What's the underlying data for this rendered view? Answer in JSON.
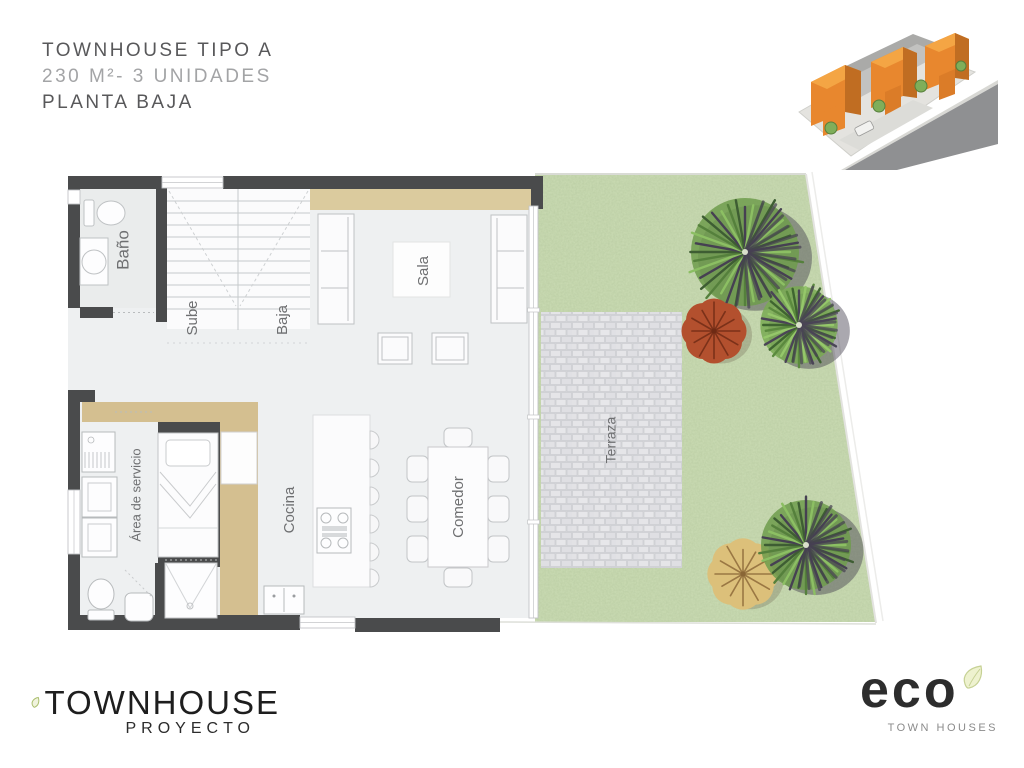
{
  "header": {
    "line1": "TOWNHOUSE TIPO A",
    "line2": "230 M²- 3 UNIDADES",
    "line3": "PLANTA BAJA"
  },
  "plan": {
    "labels": {
      "bano": "Baño",
      "sube": "Sube",
      "baja": "Baja",
      "sala": "Sala",
      "cocina": "Cocina",
      "comedor": "Comedor",
      "servicio": "Área de servicio",
      "terraza": "Terraza"
    },
    "trees": [
      {
        "type": "palm",
        "cx": 745,
        "cy": 252,
        "r": 60,
        "base": "#6f9c4c",
        "fronds": [
          "#8cbf63",
          "#55803c",
          "#3e5d33",
          "#464052"
        ],
        "shadow": true
      },
      {
        "type": "palm",
        "cx": 799,
        "cy": 325,
        "r": 43,
        "base": "#79aa52",
        "fronds": [
          "#95c76a",
          "#5b8a3e",
          "#3f6530",
          "#4a4456"
        ],
        "shadow": true
      },
      {
        "type": "round",
        "cx": 714,
        "cy": 331,
        "r": 31,
        "base": "#b3502e",
        "branch": "#6e2a14"
      },
      {
        "type": "round",
        "cx": 743,
        "cy": 574,
        "r": 34,
        "base": "#dcc07a",
        "branch": "#8a6636"
      },
      {
        "type": "palm",
        "cx": 806,
        "cy": 545,
        "r": 50,
        "base": "#6f9c4c",
        "fronds": [
          "#8cbf63",
          "#55803c",
          "#3e5d33",
          "#464052"
        ],
        "shadow": true
      }
    ]
  },
  "footer": {
    "brand": "TOWNHOUSE",
    "brand_sub": "PROYECTO",
    "logo": "eco",
    "logo_sub": "TOWN HOUSES"
  },
  "colors": {
    "wall": "#4a4b4c",
    "tan_accent": "#d4bf90",
    "sala_accent": "#dbcb9e",
    "grass": "#cbdcb4",
    "pavement": "#dfdfe2",
    "building_orange": "#e8872e",
    "leaf_green": "#a9bd6b",
    "floor": "#eef0f1"
  }
}
